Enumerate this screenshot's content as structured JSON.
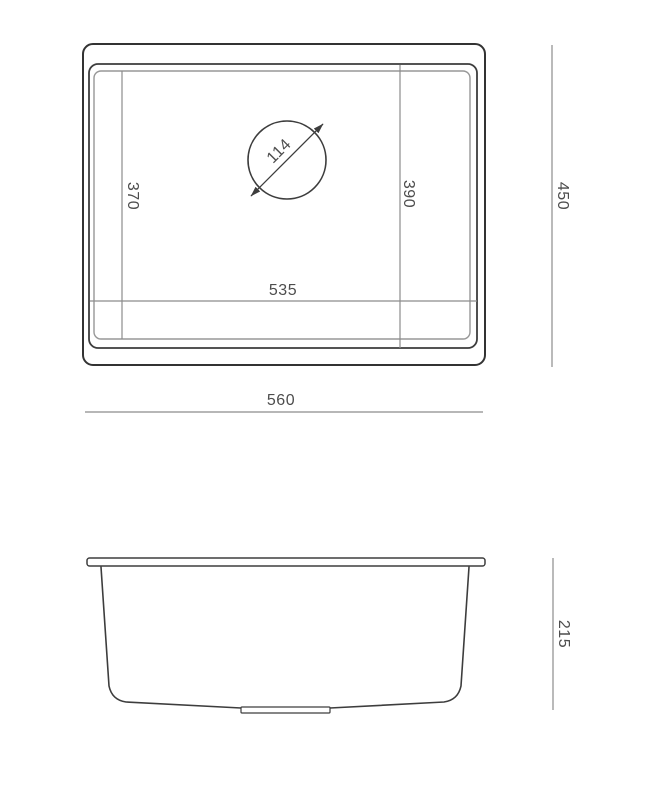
{
  "drawing": {
    "subject": "sink-technical-drawing",
    "dims": {
      "overall_width": "560",
      "overall_depth": "450",
      "bowl_width": "535",
      "bowl_depth_left": "370",
      "bowl_depth_right": "390",
      "drain_diameter": "114",
      "bowl_height": "215"
    },
    "colors": {
      "background": "#ffffff",
      "outline": "#3d3d3d",
      "outline_heavy": "#333333",
      "rim_light_line": "#979797",
      "dimension_line": "#8c8c8c",
      "label_text": "#4d4d4d"
    }
  }
}
